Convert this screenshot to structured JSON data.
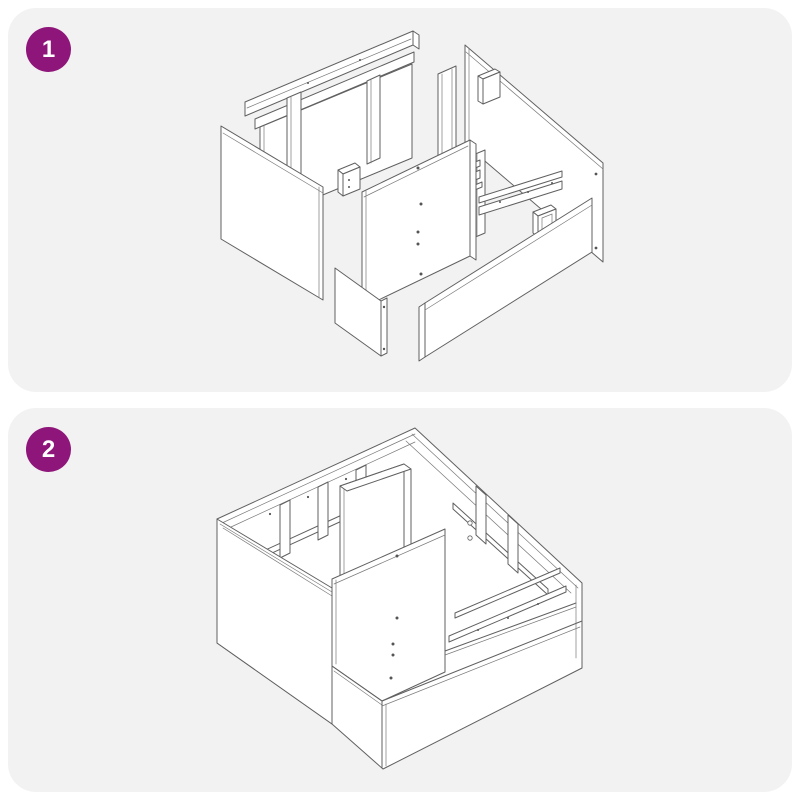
{
  "page": {
    "background": "#ffffff"
  },
  "colors": {
    "page_bg": "#ffffff",
    "panel_bg": "#f2f2f2",
    "badge_bg": "#8e1579",
    "badge_text": "#ffffff",
    "line": "#606060"
  },
  "steps": [
    {
      "number": "1",
      "illustration": "exploded-view-of-cabinet-frame-parts",
      "illustration_description": "Isometric line drawing of disassembled cabinet frame: back frame rails with studs, left side panel, center panel with screw holes, small front panel, long front rail, right side panel, support studs, bottom rails and connector blocks"
    },
    {
      "number": "2",
      "illustration": "assembled-cabinet-frame",
      "illustration_description": "Isometric line drawing of the assembled open-top cabinet frame: side walls, back frame with studs, center divider, front panel with screw holes, floor rails and bottom plinth"
    }
  ]
}
